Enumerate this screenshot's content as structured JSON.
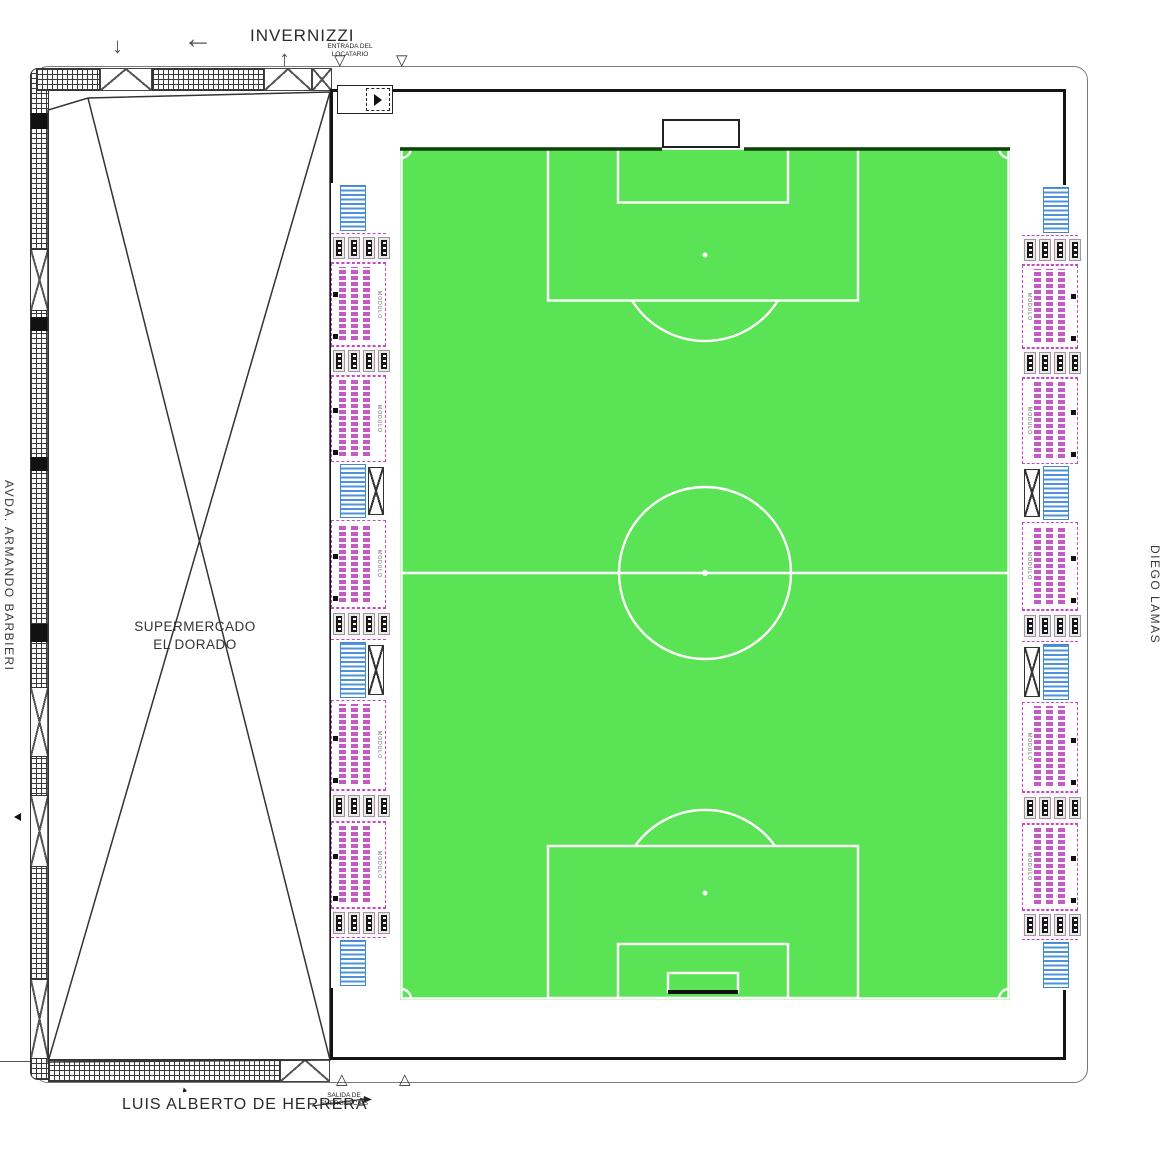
{
  "streets": {
    "top": "INVERNIZZI",
    "bottom": "LUIS ALBERTO DE HERRERA",
    "left": "AVDA. ARMANDO BARBIERI",
    "right": "DIEGO LAMAS"
  },
  "building": {
    "line1": "SUPERMERCADO",
    "line2": "EL DORADO"
  },
  "annotations": {
    "entrance_line1": "ENTRADA DEL",
    "entrance_line2": "LOCATARIO",
    "exit_line1": "SALIDA DE",
    "exit_line2": "EMERGENCIAS"
  },
  "icons": {
    "arrow_left": "←",
    "arrow_up": "↑",
    "arrow_down": "↓",
    "triangle_down": "▽",
    "triangle_up": "△",
    "cursor": "➤"
  },
  "colors": {
    "field_green": "#5be356",
    "pitch_line_white": "#ffffff",
    "goal_line_dark": "#12400f",
    "stand_magenta": "#bb4fbb",
    "stair_blue": "#3f87cf",
    "wall_black": "#141414"
  },
  "stands": {
    "module_label": "MODULO",
    "gates_per_row": 4,
    "left_segments": [
      {
        "type": "stair",
        "h": 50
      },
      {
        "type": "gates",
        "h": 30
      },
      {
        "type": "module",
        "h": 83
      },
      {
        "type": "gates",
        "h": 30
      },
      {
        "type": "module",
        "h": 86
      },
      {
        "type": "stairx",
        "h": 58
      },
      {
        "type": "module",
        "h": 88
      },
      {
        "type": "gates",
        "h": 32
      },
      {
        "type": "stairx",
        "h": 60
      },
      {
        "type": "module",
        "h": 90
      },
      {
        "type": "gates",
        "h": 32
      },
      {
        "type": "module",
        "h": 86
      },
      {
        "type": "gates",
        "h": 30
      },
      {
        "type": "stair",
        "h": 50
      }
    ],
    "right_segments": [
      {
        "type": "stair",
        "h": 50
      },
      {
        "type": "gates",
        "h": 30
      },
      {
        "type": "module",
        "h": 83
      },
      {
        "type": "gates",
        "h": 30
      },
      {
        "type": "module",
        "h": 86
      },
      {
        "type": "stairx",
        "h": 58
      },
      {
        "type": "module",
        "h": 88
      },
      {
        "type": "gates",
        "h": 32
      },
      {
        "type": "stairx",
        "h": 60
      },
      {
        "type": "module",
        "h": 90
      },
      {
        "type": "gates",
        "h": 32
      },
      {
        "type": "module",
        "h": 86
      },
      {
        "type": "gates",
        "h": 30
      },
      {
        "type": "stair",
        "h": 50
      }
    ]
  }
}
